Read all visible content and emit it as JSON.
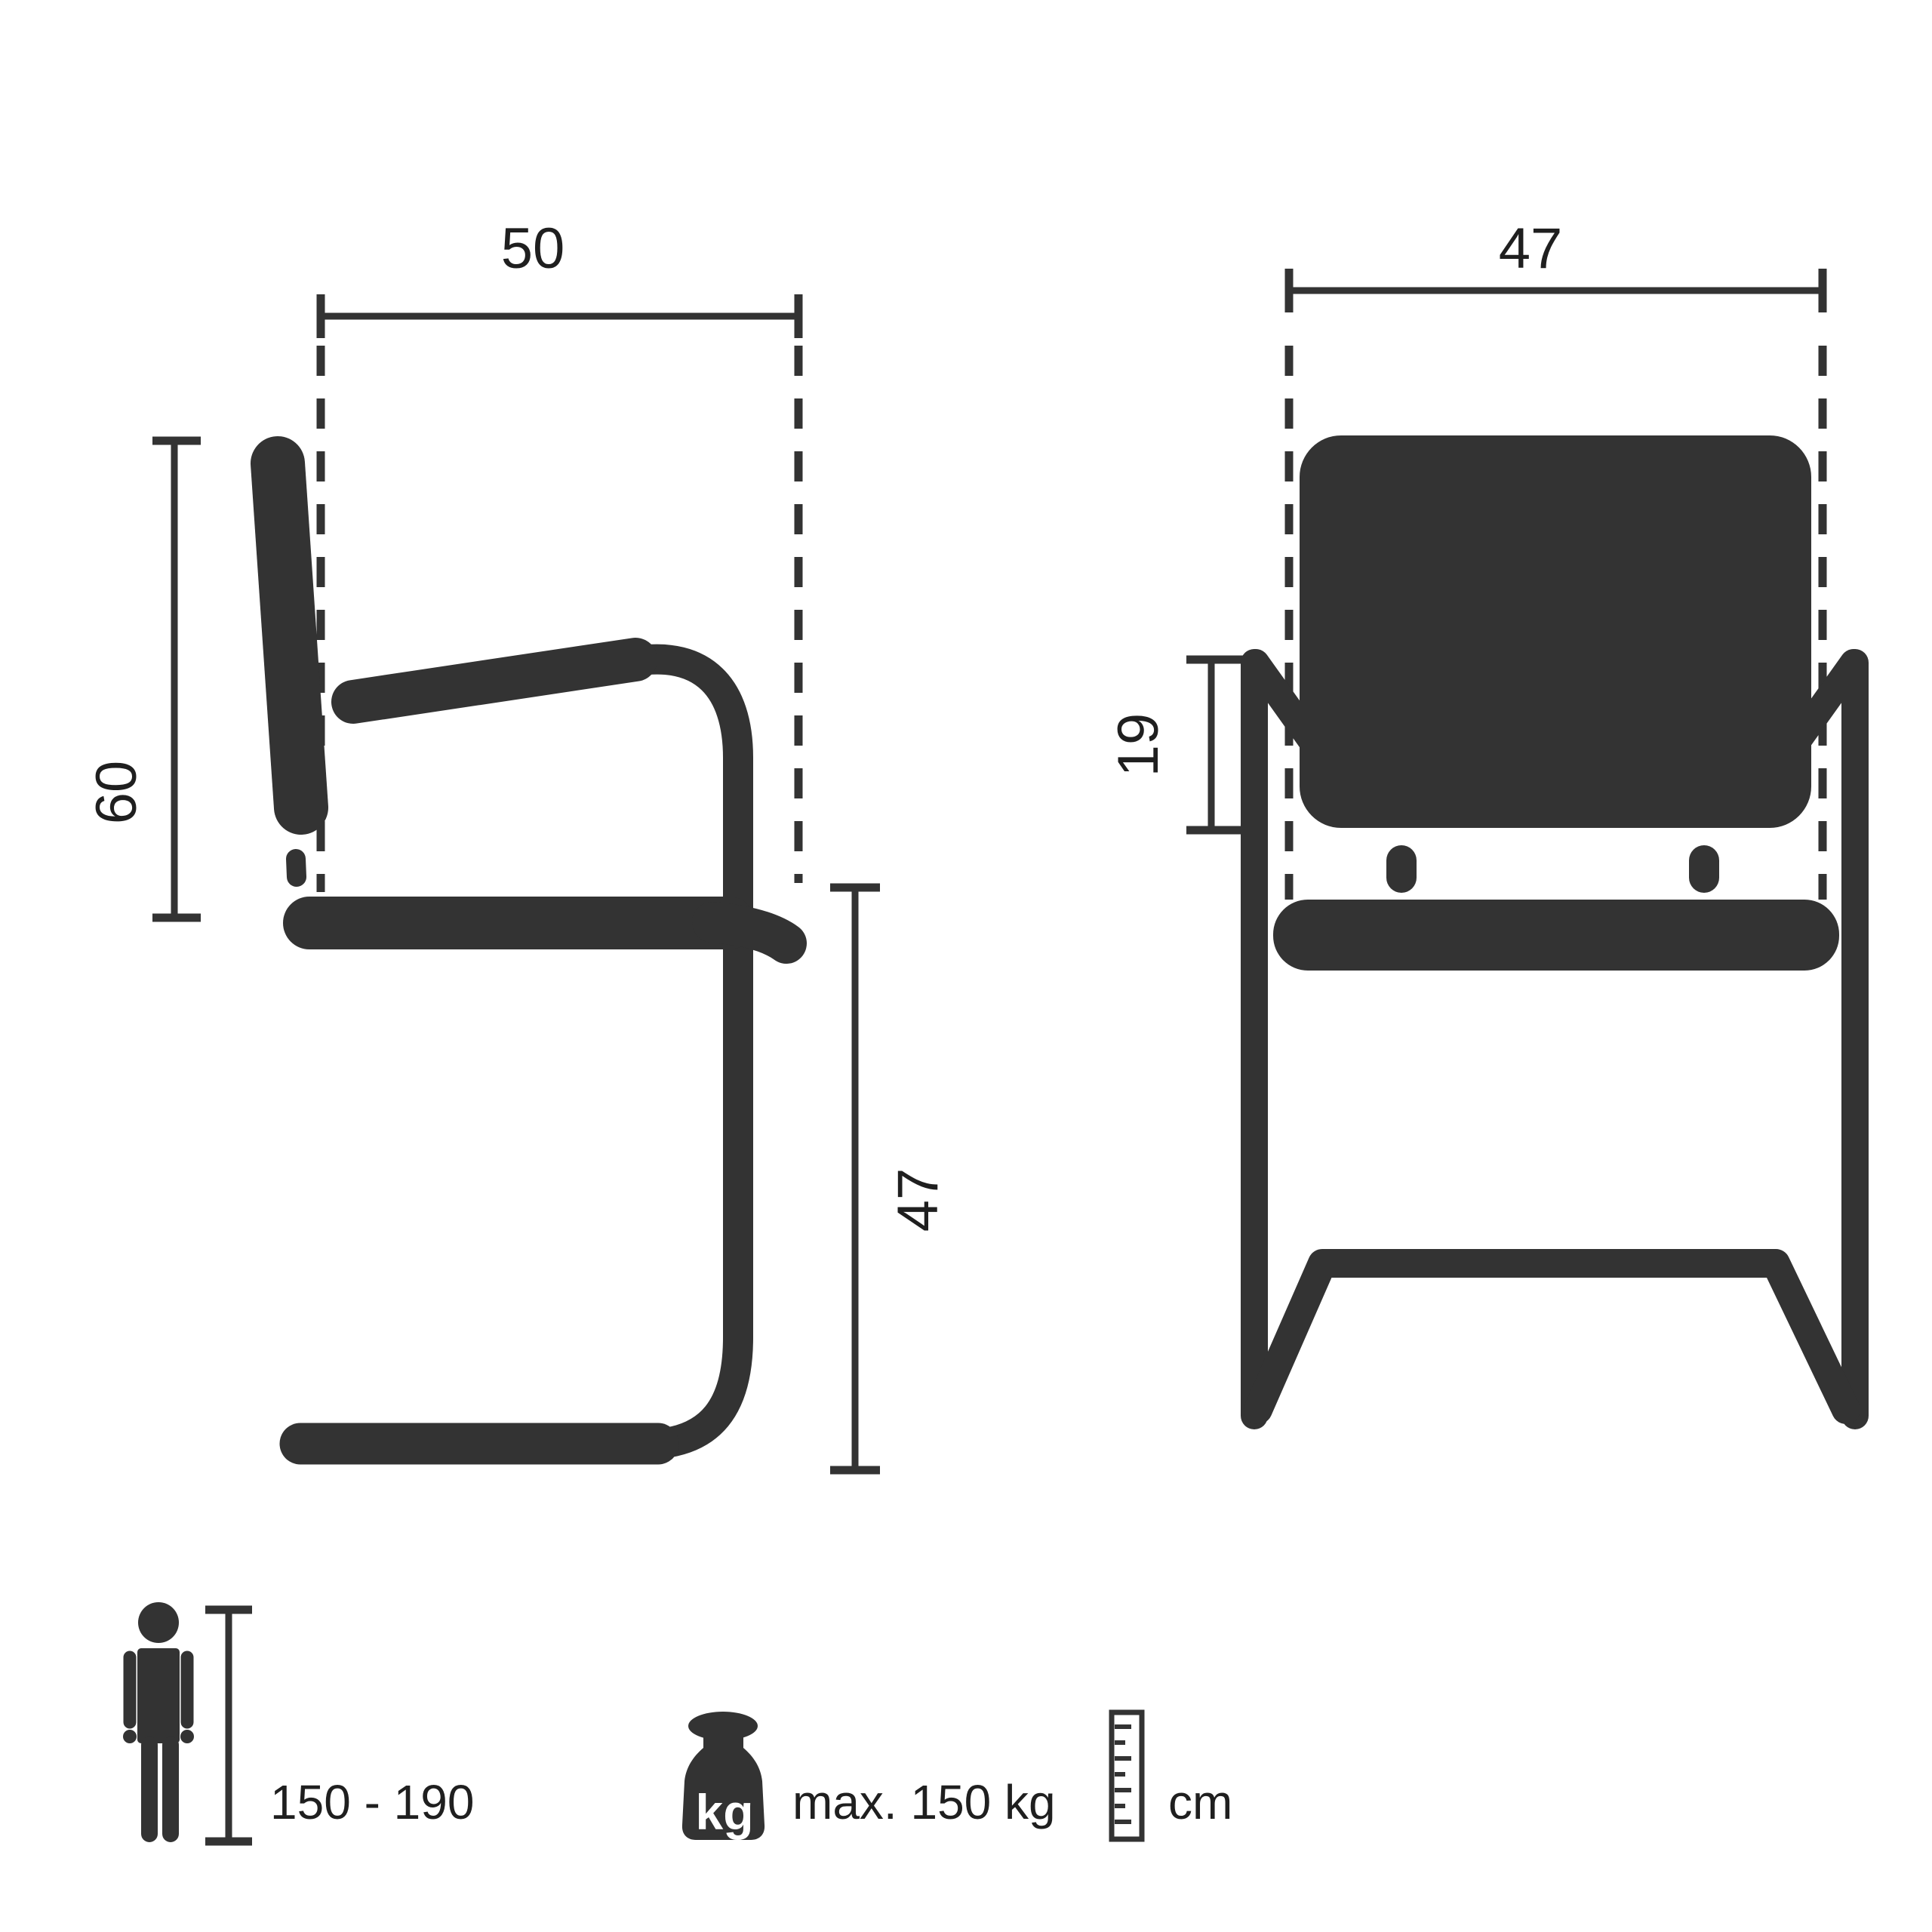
{
  "colors": {
    "ink": "#333333",
    "text": "#1f1f1f",
    "icon_label": "#ffffff",
    "background": "#ffffff"
  },
  "views": {
    "side": {
      "depth_label": "50",
      "backrest_height_label": "60",
      "seat_height_label": "47"
    },
    "front": {
      "width_label": "47",
      "armrest_height_label": "19"
    }
  },
  "footer": {
    "icons": [
      "person-height-icon",
      "weight-icon",
      "ruler-icon"
    ],
    "height_range": "150 - 190",
    "weight_icon_label": "kg",
    "max_weight": "max. 150 kg",
    "unit": "cm"
  }
}
